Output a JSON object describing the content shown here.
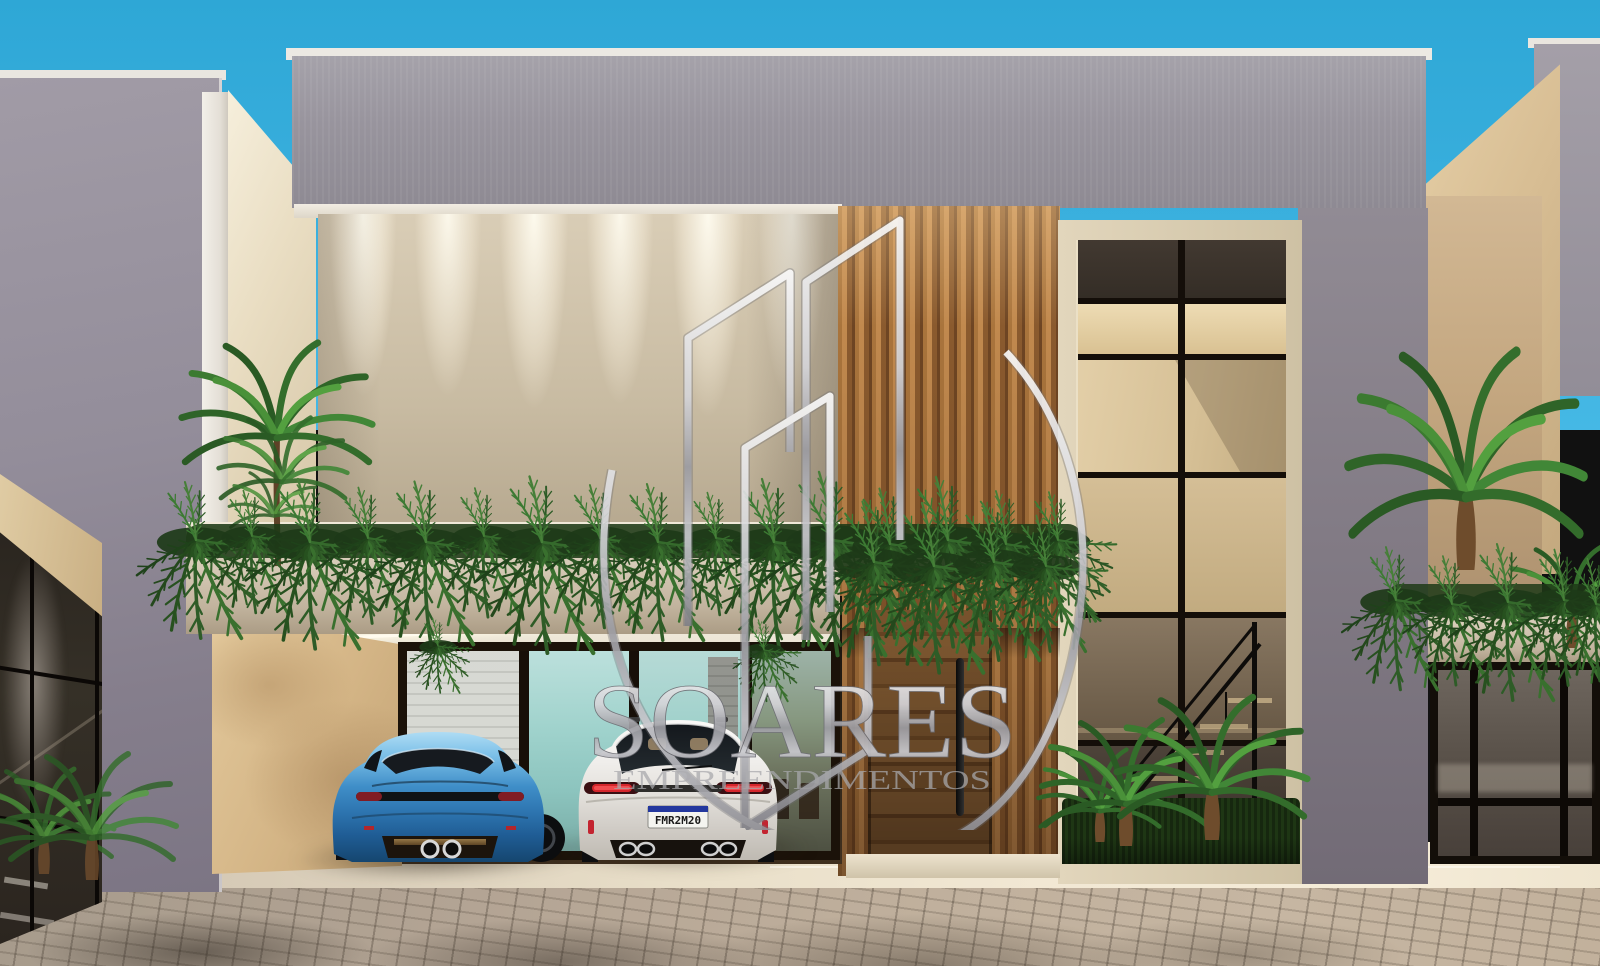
{
  "image": {
    "kind": "architectural-exterior-render",
    "description": "Photorealistic front-elevation render of a modern two-storey townhouse: grey parapet band, cream textured feature wall with wall-washer lights, vertical wood slat panel with pivot entry door, black-framed glass curtain wall revealing an interior staircase, hanging-fern planter across the facade, open garage with teal-tinted glass doors, a blue sports coupe and a white SUV parked in front, matching neighbour townhouses on both sides and a brick-paver street in the foreground under a clear blue sky.",
    "watermark_logo": "wireframe-buildings-swoosh-icon"
  },
  "watermark": {
    "title": "SOARES",
    "subtitle": "EMPREENDIMENTOS"
  },
  "license_plate": "FMR2M20",
  "vehicles": {
    "left": {
      "type": "sports coupe",
      "color_name": "metallic blue"
    },
    "right": {
      "type": "SUV",
      "color_name": "white",
      "license_plate": "FMR2M20"
    }
  },
  "palette": {
    "sky-top": "#2EA7D6",
    "sky-bottom": "#45B8E5",
    "parapet-grey": "#98949D",
    "coping-white": "#ECE9E3",
    "wall-cream": "#D9CDB6",
    "wall-cream-shadow": "#A2947C",
    "wood-mid": "#A9743C",
    "wood-dark": "#6E4523",
    "door-wood": "#8F6336",
    "glass-frame": "#E2D6BC",
    "mullion-black": "#140E09",
    "pane-warm": "#D6C096",
    "pane-dark": "#342D26",
    "planter-cream": "#D6CAB6",
    "fern-green": "#2F6428",
    "garage-frame": "#1B1209",
    "garage-ceiling": "#F7F1E3",
    "garage-glass-teal": "#9FD2CC",
    "sand-wall": "#E3C99C",
    "apron-light": "#F5ECD8",
    "paver-base": "#BFAF9C",
    "neighbor-grey": "#938D9A",
    "watermark-silver": "#C8C8CC",
    "car-blue": "#2F7FBE",
    "car-white": "#ECEAE7",
    "taillight-red": "#C1272D",
    "plate-blue": "#23379E"
  }
}
